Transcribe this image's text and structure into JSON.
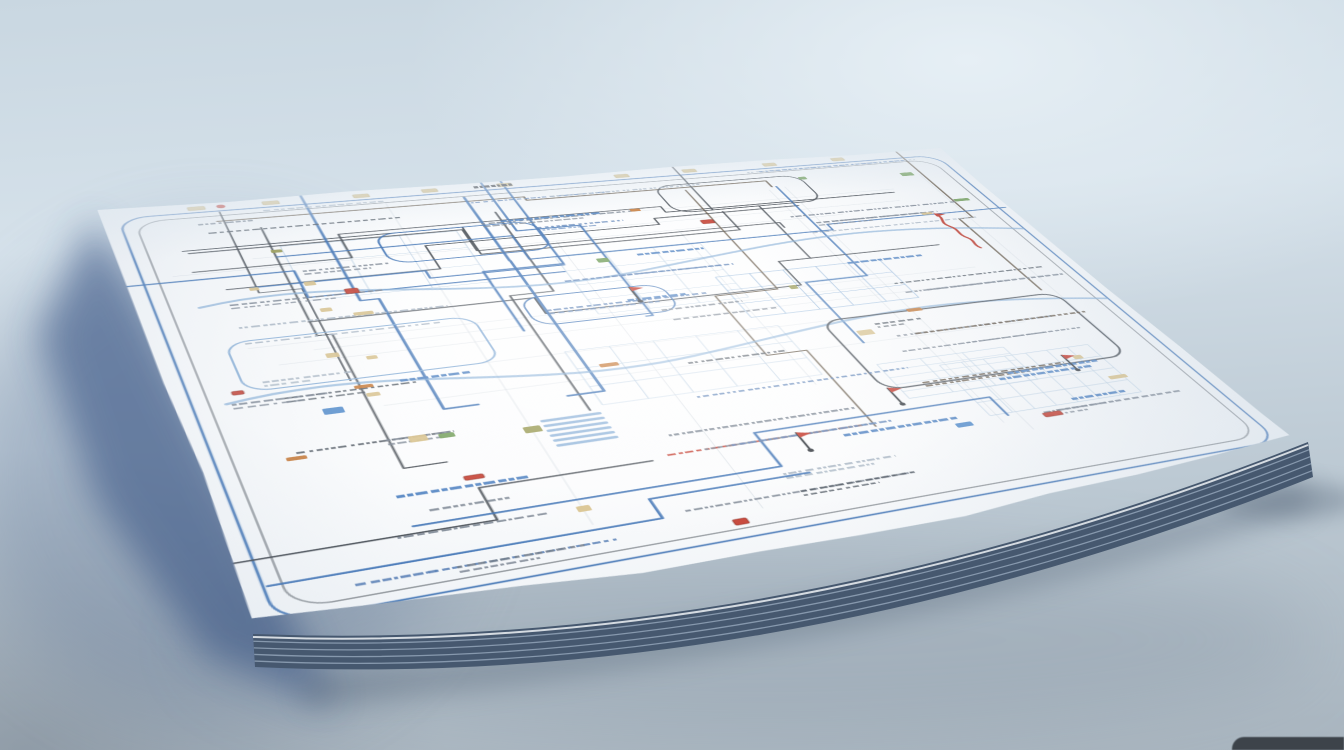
{
  "scene": {
    "description": "Photorealistic render of a large folded paper map or schematic blueprint, covered in illegible scribbled labels, blue and dark routing lines and small colored markers, lying at an angle on a pale blue-gray surface with a deep blue shadow cast to its left and a stacked page edge along its bottom.",
    "canvas": {
      "width": 1344,
      "height": 750
    }
  },
  "background": {
    "gradient_top": "#c9d7e1",
    "gradient_mid1": "#d5e1ea",
    "gradient_mid2": "#bfccd6",
    "gradient_bottom": "#a9b5bf",
    "highlight": "#e6eff5",
    "bottom_left_shade": "rgba(92,104,118,0.38)",
    "corner_object_color": "#343a41"
  },
  "shadow": {
    "core": "#2d4c7e",
    "halo": "#5c7296",
    "under": "#4a5a6e",
    "ambient": "#6b7a8c"
  },
  "paper": {
    "corners_screen": {
      "tl": [
        97,
        209
      ],
      "tr": [
        938,
        146
      ],
      "bl": [
        263,
        648
      ],
      "br": [
        1310,
        452
      ]
    },
    "flat_size": [
      1000,
      800
    ],
    "fill_center": "#ffffff",
    "fill_mid": "#fbfcfd",
    "fill_edge": "#e9eef3",
    "stack_color": "#46586f",
    "stack_line_color": "#9cadc1",
    "stack_thickness": 33
  },
  "map": {
    "seed": 11,
    "ink": {
      "dark": "#3e454d",
      "brown": "#5a4b3a",
      "blue": "#3a6fb2",
      "light_blue": "#7fa9d4",
      "pale_blue": "#b8cee2",
      "faint": "#ccd4dc",
      "text_gray": "#75808d",
      "text_blue": "#5c82b6",
      "text_light": "#a3b1bf",
      "text_dark": "#49525c",
      "bold_blue": "#4c80c0"
    },
    "marker_colors": {
      "red": "#c23527",
      "red_border": "#7e1f16",
      "tan": "#d6bf87",
      "green": "#6e9b54",
      "orange": "#c4742f",
      "blue": "#4a86c8",
      "olive": "#97984f",
      "pin_dark": "#33383e"
    },
    "counts": {
      "scribble_row_min_gap": 21,
      "scribble_row_max_gap": 34,
      "bold_labels": 10,
      "dark_roads_h": 7,
      "dark_roads_v": 6,
      "blue_roads_h": 5,
      "blue_roads_v": 5,
      "rivers": 2,
      "grid_patches": 6,
      "faint_lines_h": 8,
      "faint_lines_v": 6,
      "markers": 34
    },
    "border_loop": {
      "x": 16,
      "y": 28,
      "w": 966,
      "h": 744,
      "rx": 30
    },
    "features": {
      "loops": [
        {
          "x": 64,
          "y": 322,
          "w": 232,
          "h": 96,
          "color": "light_blue",
          "width": 2.0
        },
        {
          "x": 252,
          "y": 118,
          "w": 172,
          "h": 72,
          "color": "blue",
          "width": 2.2
        },
        {
          "x": 588,
          "y": 54,
          "w": 186,
          "h": 76,
          "color": "dark",
          "width": 2.0
        },
        {
          "x": 636,
          "y": 418,
          "w": 292,
          "h": 152,
          "color": "dark",
          "width": 2.4
        },
        {
          "x": 352,
          "y": 296,
          "w": 152,
          "h": 62,
          "color": "blue",
          "width": 1.8
        }
      ],
      "squiggle": {
        "x": 893,
        "y": 198,
        "color": "#c0392b"
      },
      "pins": [
        [
          640,
          600
        ],
        [
          515,
          655
        ],
        [
          855,
          585
        ],
        [
          470,
          330
        ]
      ],
      "ladder": {
        "x": 298,
        "y": 538,
        "rungs": 6,
        "step": 9,
        "len": 54
      },
      "top_strip": {
        "y": 13,
        "tan_xs": [
          85,
          160,
          255,
          330,
          415,
          555,
          640,
          745,
          838
        ],
        "red_x": 118,
        "blob_x": 388
      }
    }
  }
}
